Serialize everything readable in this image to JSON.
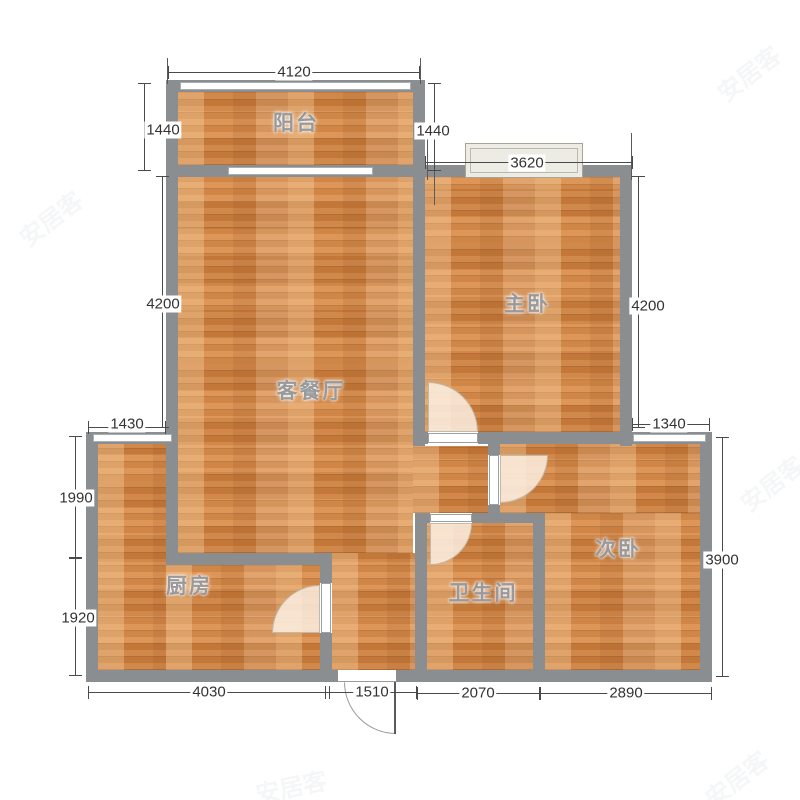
{
  "title": "apartment-floor-plan",
  "rooms": {
    "balcony": {
      "label": "阳台"
    },
    "living": {
      "label": "客餐厅"
    },
    "master": {
      "label": "主卧"
    },
    "kitchen": {
      "label": "厨房"
    },
    "bath": {
      "label": "卫生间"
    },
    "bed2": {
      "label": "次卧"
    }
  },
  "dims": {
    "top": "4120",
    "master_window": "3620",
    "balcony_left": "1440",
    "balcony_right": "1440",
    "living_height": "4200",
    "master_height": "4200",
    "kitchen_top_width": "1430",
    "bed2_window": "1340",
    "kitchen_upper_height": "1990",
    "kitchen_lower_height": "1920",
    "bed2_height": "3900",
    "bottom_kitchen": "4030",
    "bottom_entry": "1510",
    "bottom_bath": "2070",
    "bottom_bed2": "2890"
  },
  "watermark": {
    "text": "安居客"
  },
  "colors": {
    "floor": "#d8853f",
    "wall": "#8b8e91",
    "door_sweep": "#f7e6d3",
    "dim_text": "#333333"
  }
}
